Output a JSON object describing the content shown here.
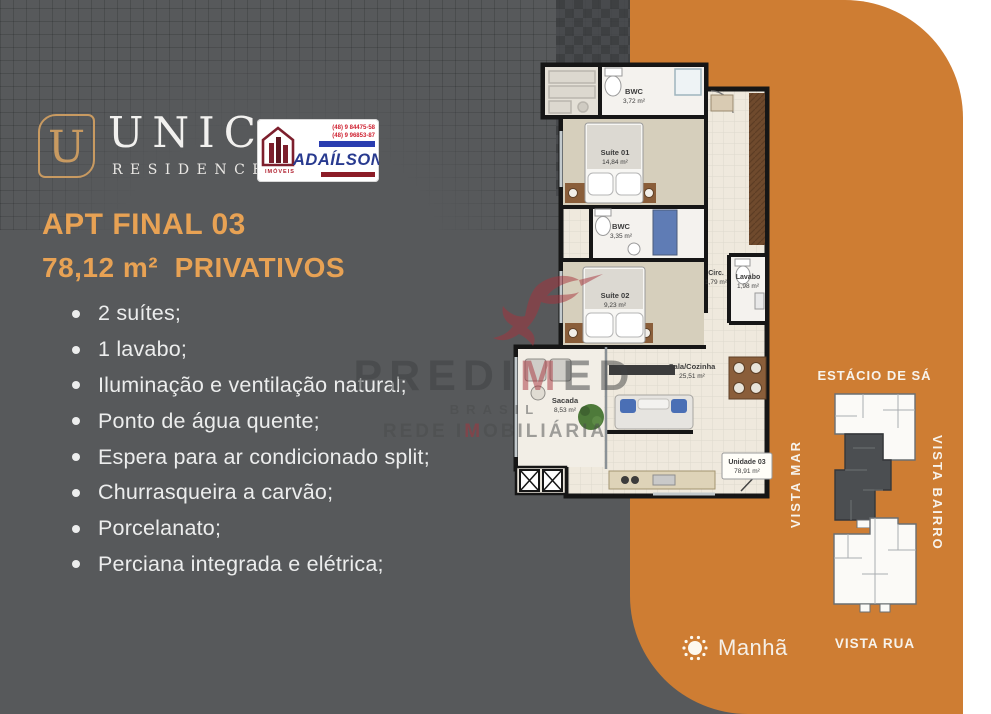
{
  "brand": {
    "tile_letter": "U",
    "name": "UNIC",
    "subtitle": "RESIDENCE",
    "gold": "#c89a61"
  },
  "agency": {
    "name": "ADAÍLSON",
    "tagline": "IMÓVEIS",
    "phone1": "(48) 9 84475-58",
    "phone2": "(48) 9 96853-87",
    "blue": "#283a8f",
    "red": "#8c1c27"
  },
  "header": {
    "title": "APT FINAL 03",
    "subtitle": "78,12 m²  PRIVATIVOS",
    "accent_color": "#e8a254"
  },
  "features": [
    "2 suítes;",
    "1 lavabo;",
    "Iluminação e ventilação natural;",
    "Ponto de água quente;",
    "Espera para ar condicionado split;",
    "Churrasqueira a carvão;",
    "Porcelanato;",
    "Perciana integrada e elétrica;"
  ],
  "floorplan": {
    "rooms": [
      {
        "name": "BWC",
        "area": "3,72 m²"
      },
      {
        "name": "Suíte 01",
        "area": "14,84 m²"
      },
      {
        "name": "BWC",
        "area": "3,35 m²"
      },
      {
        "name": "Suíte 02",
        "area": "9,23 m²"
      },
      {
        "name": "Circ.",
        "area": "1,79 m²"
      },
      {
        "name": "Lavabo",
        "area": "1,98 m²"
      },
      {
        "name": "Sala/Cozinha",
        "area": "25,51 m²"
      },
      {
        "name": "Sacada",
        "area": "8,53 m²"
      }
    ],
    "unit": {
      "name": "Unidade 03",
      "area": "78,91 m²"
    }
  },
  "orientation": {
    "top": "ESTÁCIO DE SÁ",
    "left": "VISTA MAR",
    "right": "VISTA BAIRRO",
    "bottom": "VISTA RUA",
    "sun": "Manhã"
  },
  "watermark": {
    "brand_pre": "PREDI",
    "brand_accent": "M",
    "brand_suf": "ED",
    "line2": "BRASIL",
    "line3_pre": "REDE I",
    "line3_accent": "M",
    "line3_suf": "OBILIÁRIA"
  },
  "colors": {
    "panel_left": "#57595b",
    "panel_right": "#ce7d33"
  }
}
